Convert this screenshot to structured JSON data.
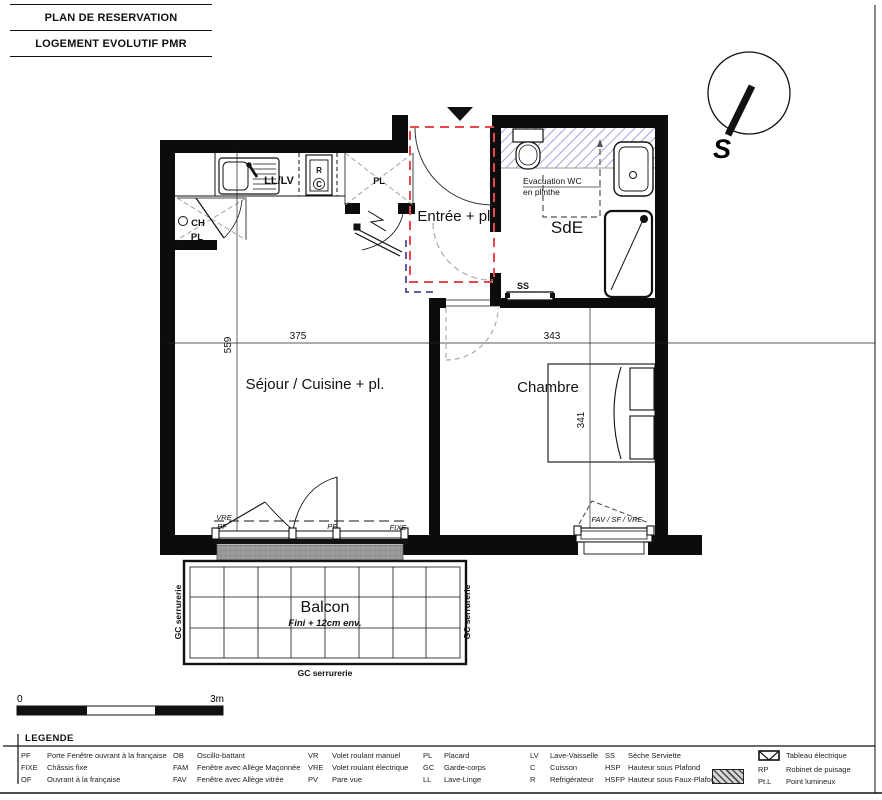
{
  "header": {
    "line1": "PLAN DE RESERVATION",
    "line2": "LOGEMENT EVOLUTIF PMR"
  },
  "compass": {
    "south_label": "S"
  },
  "plan": {
    "rooms": {
      "entree": "Entrée + pl.",
      "sde": "SdE",
      "sejour": "Séjour / Cuisine + pl.",
      "chambre": "Chambre",
      "balcon": "Balcon",
      "balcon_note": "Fini + 12cm env."
    },
    "labels": {
      "ll_lv": "LL/LV",
      "r": "R",
      "c": "C",
      "pl_kitchen": "PL",
      "ch": "CH",
      "pl_entry": "PL",
      "ss": "SS",
      "evacuation_line1": "Evacuation WC",
      "evacuation_line2": "en plinthe",
      "window_vre": "VRE",
      "window_pf_left": "PF",
      "window_pf_mid": "PF",
      "window_fixe": "FIXE",
      "window_chambre": "FAV / SF / VRE",
      "gc_left": "GC serrurerie",
      "gc_right": "GC serrurerie",
      "gc_bottom": "GC serrurerie"
    },
    "dimensions": {
      "sejour_width": "375",
      "chambre_width": "343",
      "sejour_height": "559",
      "chambre_height": "341"
    }
  },
  "scale_bar": {
    "start": "0",
    "end": "3m"
  },
  "legend": {
    "title": "LEGENDE",
    "columns": [
      {
        "items": [
          {
            "abbr": "PF",
            "label": "Porte Fenêtre ouvrant à la française"
          },
          {
            "abbr": "FIXE",
            "label": "Châssis fixe"
          },
          {
            "abbr": "OF",
            "label": "Ouvrant à la française"
          }
        ]
      },
      {
        "items": [
          {
            "abbr": "OB",
            "label": "Oscillo-battant"
          },
          {
            "abbr": "FAM",
            "label": "Fenêtre avec Allège Maçonnée"
          },
          {
            "abbr": "FAV",
            "label": "Fenêtre avec Allège vitrée"
          }
        ]
      },
      {
        "items": [
          {
            "abbr": "VR",
            "label": "Volet roulant manuel"
          },
          {
            "abbr": "VRE",
            "label": "Volet roulant électrique"
          },
          {
            "abbr": "PV",
            "label": "Pare vue"
          }
        ]
      },
      {
        "items": [
          {
            "abbr": "PL",
            "label": "Placard"
          },
          {
            "abbr": "GC",
            "label": "Garde-corps"
          },
          {
            "abbr": "LL",
            "label": "Lave-Linge"
          }
        ]
      },
      {
        "items": [
          {
            "abbr": "LV",
            "label": "Lave-Vaisselle"
          },
          {
            "abbr": "C",
            "label": "Cuisson"
          },
          {
            "abbr": "R",
            "label": "Refrigérateur"
          }
        ]
      },
      {
        "items": [
          {
            "abbr": "SS",
            "label": "Sèche Serviette"
          },
          {
            "abbr": "HSP",
            "label": "Hauteur sous Plafond"
          },
          {
            "abbr": "HSFP",
            "label": "Hauteur sous Faux-Plafond"
          }
        ]
      },
      {
        "items": [
          {
            "abbr": "",
            "label": "Tableau électrique"
          },
          {
            "abbr": "RP",
            "label": "Robinet de puisage"
          },
          {
            "abbr": "Pt.L",
            "label": "Point lumineux"
          }
        ]
      }
    ]
  }
}
